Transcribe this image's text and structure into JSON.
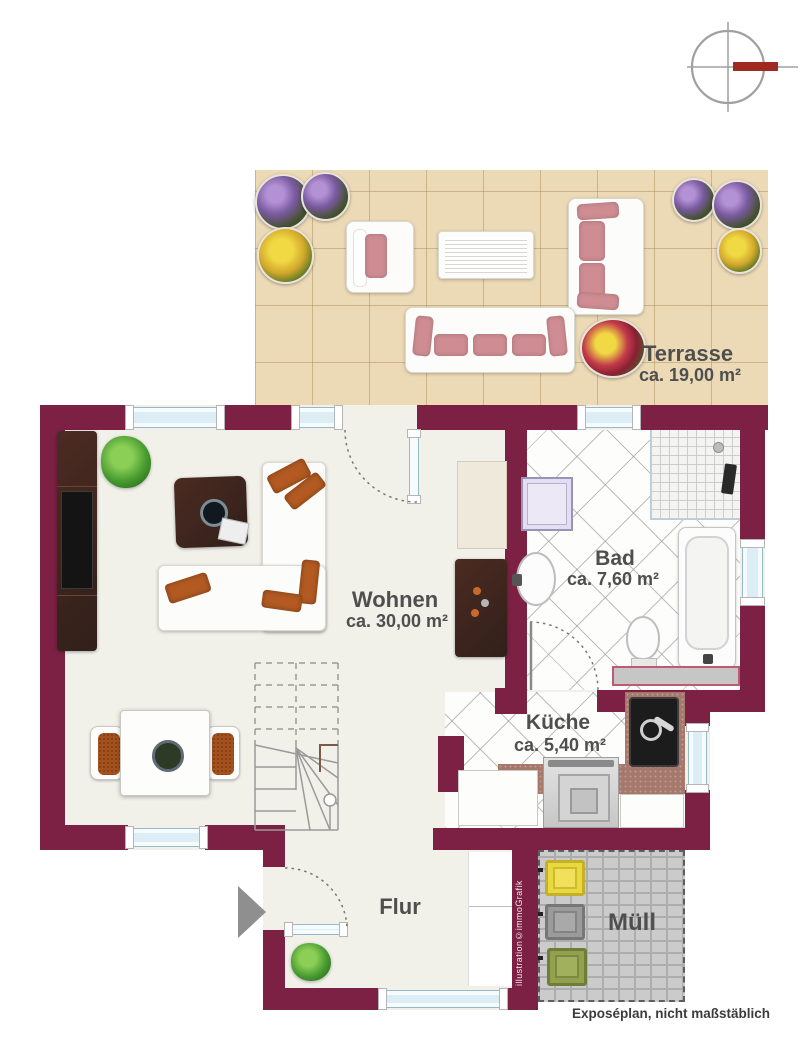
{
  "labels": {
    "terrasse": {
      "name": "Terrasse",
      "area": "ca. 19,00 m²"
    },
    "wohnen": {
      "name": "Wohnen",
      "area": "ca. 30,00 m²"
    },
    "bad": {
      "name": "Bad",
      "area": "ca. 7,60 m²"
    },
    "kueche": {
      "name": "Küche",
      "area": "ca. 5,40 m²"
    },
    "flur": {
      "name": "Flur"
    },
    "muell": {
      "name": "Müll"
    }
  },
  "annotations": {
    "watermark": "illustration©immoGrafik",
    "disclaimer": "Exposéplan, nicht maßstäblich"
  },
  "colors": {
    "wall": "#7c2143",
    "interior_floor": "#f1f0e9",
    "terrace_tile": "#ecdab6",
    "window": "#dcedf5",
    "compass_accent": "#9e2a21",
    "sofa_cushion_pink": "#cf8d93",
    "pillow_orange": "#b35a22",
    "bin_yellow": "#ead83f",
    "bin_gray": "#9b9b9b",
    "bin_green": "#93a14e"
  }
}
